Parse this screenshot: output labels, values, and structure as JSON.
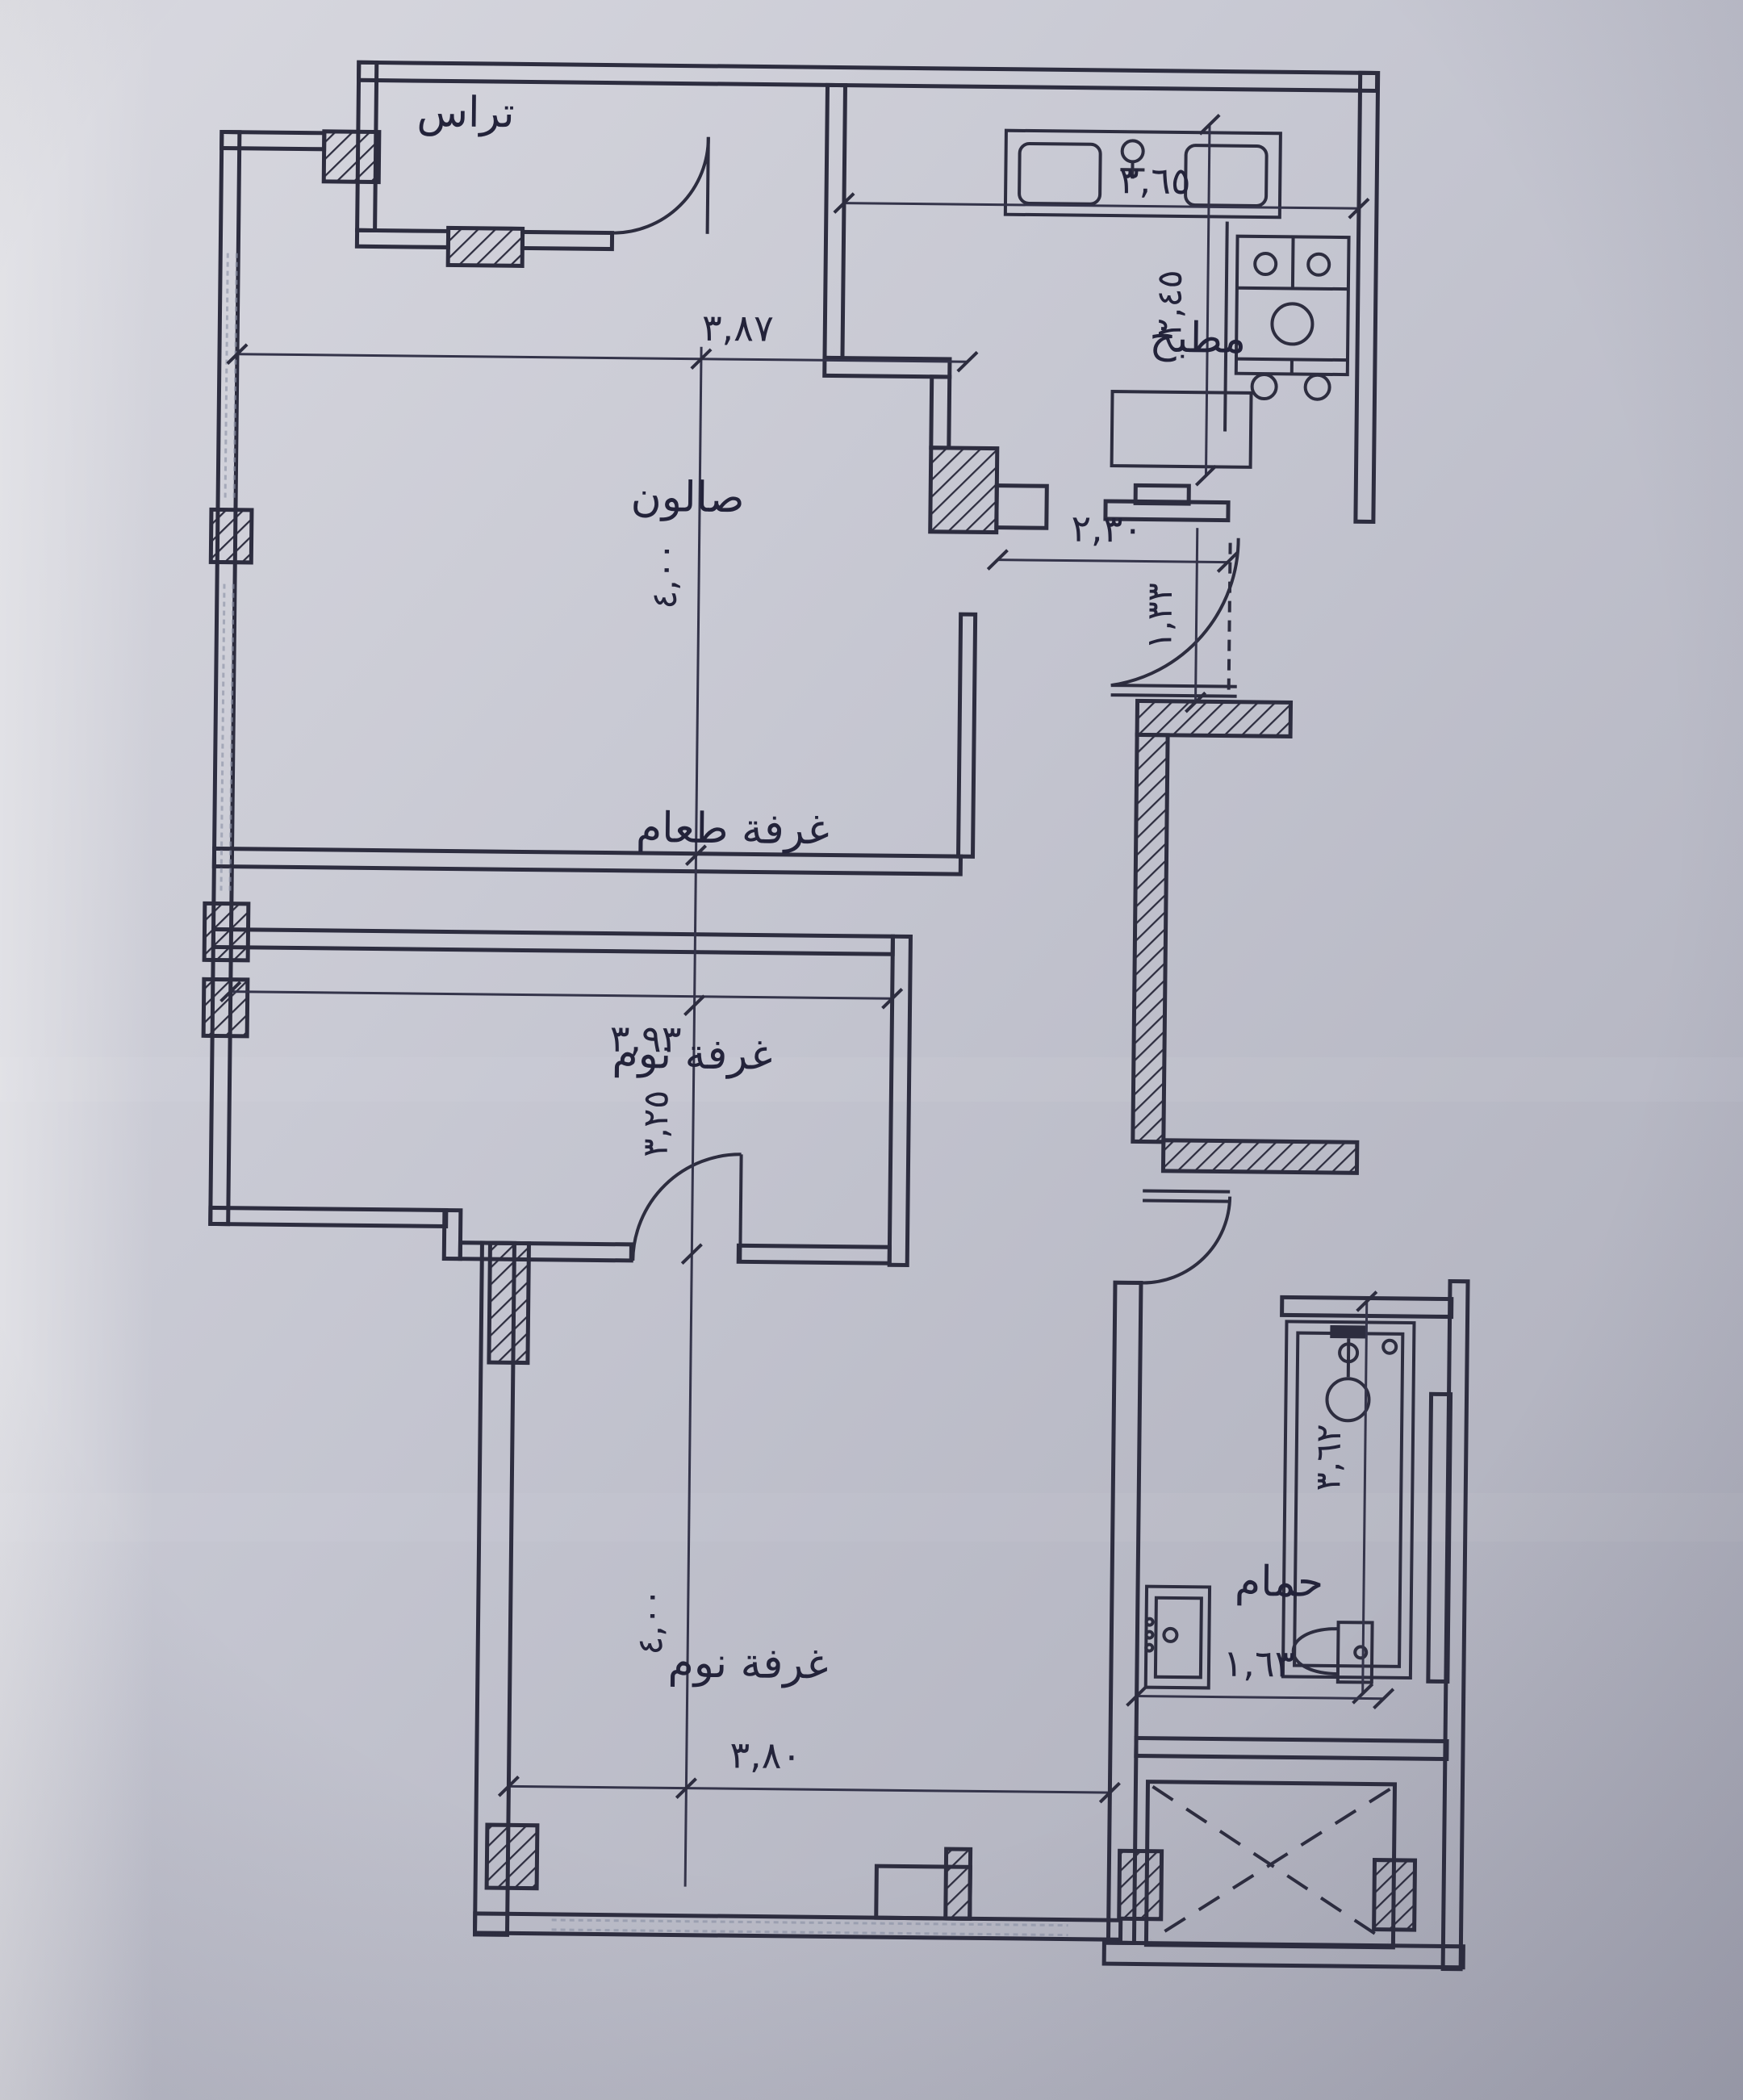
{
  "meta": {
    "kind": "architectural floor plan photo",
    "language": "Arabic",
    "units": "meters"
  },
  "palette": {
    "paper_light": "#d8d8df",
    "paper_mid": "#c3c4cf",
    "paper_dark": "#aeafbc",
    "ink": "#2d2d3f"
  },
  "rooms": {
    "terrace": {
      "label": "تراس"
    },
    "kitchen": {
      "label": "مطبخ"
    },
    "salon": {
      "label": "صالون"
    },
    "dining": {
      "label": "غرفة طعام"
    },
    "bedroom1": {
      "label": "غرفة نوم"
    },
    "bedroom2": {
      "label": "غرفة نوم"
    },
    "bathroom": {
      "label": "حمام"
    }
  },
  "dimensions": {
    "salon_width": "٣,٨٧",
    "salon_depth": "٤,٠٠",
    "kitchen_width": "٣,٦٥",
    "kitchen_depth": "٢,٤٥",
    "hall_width": "٢,٣٠",
    "entry_depth": "١,٣٣",
    "bedroom1_width": "٣,٩٣",
    "bedroom1_depth": "٣,٢٥",
    "bathroom_depth": "٣,٦٢",
    "bathroom_width": "١,٦٣",
    "bedroom2_width": "٣,٨٠",
    "bedroom2_depth": "٤,٠٠"
  },
  "fixtures": {
    "kitchen_sink": "double-bowl sink",
    "stove": "4-burner stove",
    "shower": "shower tray",
    "wash_basin": "wash basin",
    "toilet": "toilet",
    "shaft": "light shaft"
  }
}
